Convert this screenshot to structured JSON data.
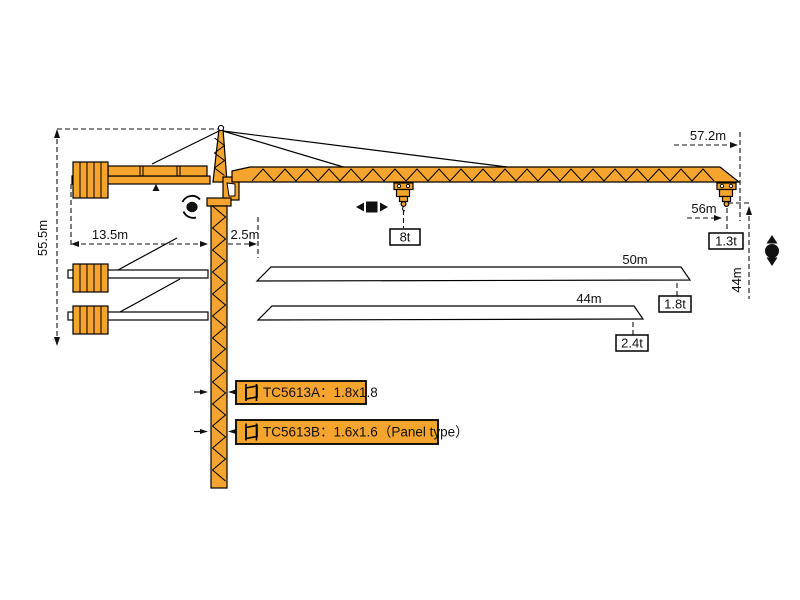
{
  "colors": {
    "crane_orange": "#F5A42E",
    "outline": "#111111",
    "label_bg": "#FFFFFF"
  },
  "dim_labels": {
    "tower_height": "55.5m",
    "counter_jib_radius": "13.5m",
    "rear_offset": "2.5m",
    "jib_tip_length": "57.2m",
    "max_hook_radius": "56m",
    "tip_hook_height": "44m",
    "jib_variant_50": "50m",
    "jib_variant_44": "44m"
  },
  "load_labels": {
    "max_load": "8t",
    "tip_load_56m": "1.3t",
    "tip_load_50m": "1.8t",
    "tip_load_44m": "2.4t"
  },
  "model_labels": {
    "variant_a": "TC5613A：1.8x1.8",
    "variant_b": "TC5613B：1.6x1.6（Panel type）"
  }
}
